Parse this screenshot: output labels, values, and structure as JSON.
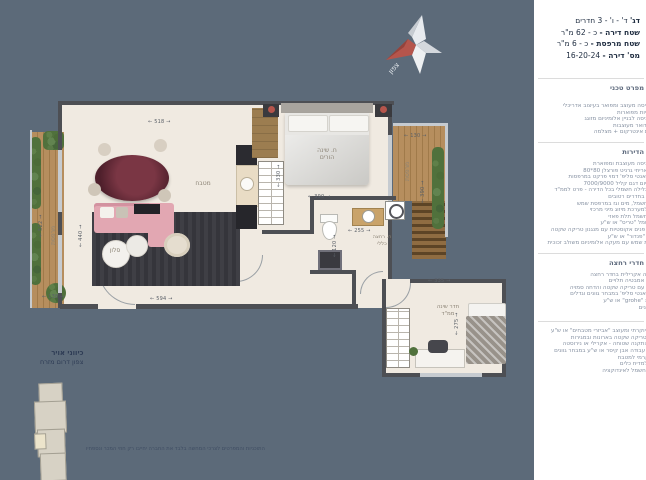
{
  "colors": {
    "background": "#5c6a79",
    "panel": "#ffffff",
    "accent_red": "#b5554c",
    "floor": "#f0eae1",
    "wall": "#4d4f54"
  },
  "header": {
    "model_label": "דג'",
    "model_value": "ד' - ו' - 3 חדרים",
    "rows": [
      {
        "label": "שטח דירה -",
        "value": "כ - 62 מ\"ר"
      },
      {
        "label": "שטח מרפסת -",
        "value": "כ - 6 מ\"ר"
      },
      {
        "label": "מס' דירה -",
        "value": "16-20-24"
      }
    ]
  },
  "spec": {
    "title": "מפרט טכני",
    "sections": [
      {
        "title": "",
        "items": [
          "לובי כניסה מעוצב ומפואר בעיצוב אדריכלי",
          "2 מעליות מפוארות",
          "דלת כניסה לבניין אלומיניום מזוגג",
          "תיבות דואר מעוצבות",
          "מערכת אינטרקום + מצלמה"
        ]
      },
      {
        "title": "הדירות",
        "items": [
          "דלת כניסה מעוצבת ומפוארת",
          "ריצוף אריחי גרניט פורצלן 80*80",
          "ריצוף 'אנטי סליפ' דמוי פרקט במרפסות",
          "אלומיניום דגם קליל 7000/9000",
          "תריסי גלילה חשמלי בכל הדירה - פרט לממ\"ד",
          "חלונות בחדרים רטובים",
          "הכנת חשמל, מים וגז במרפסת שמש",
          "הכנה למערכת מיזוג מיני מרכזי",
          "חיבור חשמל תלת פאזי",
          "דוד חשמל \"טריס\" או ש\"ע",
          "דלתות פנים אקוסטיות עם מנגנון טריקה שקטה",
          "דלתות \"פנדור\" או ש\"ע",
          "מרפסת שמש עם מעקה אלומיניום משולב זכוכית"
        ]
      },
      {
        "title": "חדרי רחצה",
        "items": [
          "אמבטיה אקרילית בחדר רחצה",
          "ארונות אמבטיה תלויים",
          "אסלות עם טריקה שקטה והדחה סמויה",
          "ריצוף 'אנטי סליפ' במבחר גוונים וגדלים",
          "סוללות \"grohe\" או ש\"ע",
          "מקלחונים"
        ]
      },
      {
        "title": "",
        "items": [
          "מטבח יוקרתי ומעוצב \"אביזרי מטבחים\" או ש\"ע",
          "מנגנון טריקה שקטה בארונות ובמגירות",
          "כיור בהתקנה שטוחה - אקרילי או נירוסטה",
          "משטח עבודה אבן קיסר או ש\"ע במבחר גוונים",
          "חיפוי קרמי למטבח",
          "הכנה למדיח כלים",
          "נקודת חשמל לאינדוקציה"
        ]
      }
    ]
  },
  "compass": {
    "north_label": "צפון"
  },
  "plan": {
    "rooms": {
      "living": "סלון",
      "kitchen": "מטבח",
      "master_line1": "ח. שינה",
      "master_line2": "הורים",
      "bath_line1": "ח. רחצה",
      "bath_line2": "כללי",
      "mamad_line1": "חדר שינה",
      "mamad_line2": "ממ\"ד",
      "balcony_left": "מרפסת",
      "balcony_right": "מרפסת"
    },
    "dims": {
      "living_width": "518",
      "living_bottom": "594",
      "living_height": "440",
      "balcony_left_height": "522",
      "balcony_left_width": "138",
      "bedroom_height": "330",
      "bedroom_width": "390",
      "balcony_right_width": "130",
      "balcony_right_height": "390",
      "bathroom_width": "255",
      "bathroom_height": "120",
      "mamad_width": "335",
      "mamad_height": "275"
    }
  },
  "footer": {
    "air_title": "כיווני אויר",
    "air_directions": "צפון דרום מזרח",
    "disclaimer": "התוכניות והמפרטים לצרכי המחשה בלבד את החברה יחייבו רק חוזי המכר ונספחיו"
  }
}
